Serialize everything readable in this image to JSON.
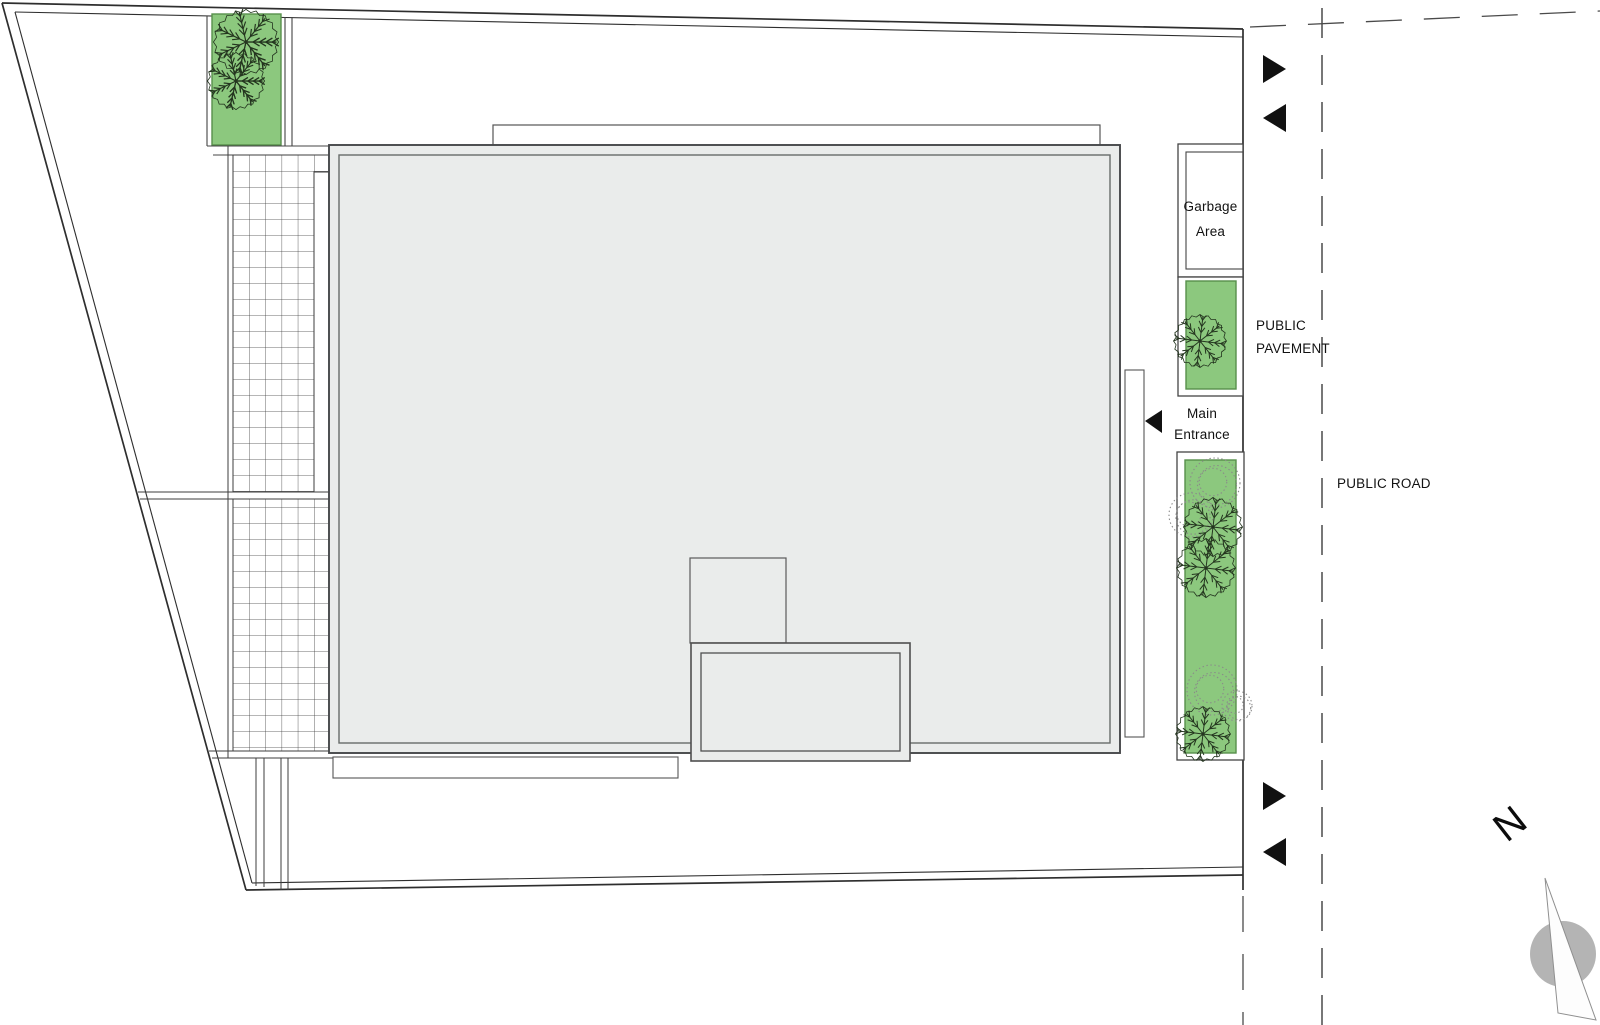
{
  "page_title": "Architectural site plan",
  "labels": {
    "garbage_line1": "Garbage",
    "garbage_line2": "Area",
    "pavement_line1": "PUBLIC",
    "pavement_line2": "PAVEMENT",
    "entrance_line1": "Main",
    "entrance_line2": "Entrance",
    "road": "PUBLIC ROAD",
    "north": "N"
  },
  "colors": {
    "planting_green": "#8cc87e",
    "planting_border": "#57904c",
    "building_fill": "#eaeceb",
    "line_dark": "#2e2e2e",
    "arrow_black": "#111111",
    "compass_gray": "#b4b4b4",
    "tree_stroke": "#24351f",
    "bush_stroke": "#8a8a8a"
  },
  "plan": {
    "trees": [
      {
        "x": 246,
        "y": 42,
        "r": 32,
        "style": "dense",
        "name": "tree-topleft-1"
      },
      {
        "x": 236,
        "y": 81,
        "r": 28,
        "style": "dense",
        "name": "tree-topleft-2"
      },
      {
        "x": 1200,
        "y": 341,
        "r": 26,
        "style": "snow",
        "name": "tree-pavement-strip"
      },
      {
        "x": 1213,
        "y": 527,
        "r": 29,
        "style": "snow",
        "name": "tree-road-strip-1"
      },
      {
        "x": 1206,
        "y": 568,
        "r": 29,
        "style": "snow",
        "name": "tree-road-strip-2"
      },
      {
        "x": 1203,
        "y": 734,
        "r": 27,
        "style": "snow",
        "name": "tree-road-strip-3"
      }
    ],
    "bushes": [
      {
        "x": 1215,
        "y": 483,
        "r": 25,
        "name": "bush-road-strip-1"
      },
      {
        "x": 1191,
        "y": 515,
        "r": 22,
        "name": "bush-road-strip-2"
      },
      {
        "x": 1212,
        "y": 690,
        "r": 25,
        "name": "bush-road-strip-3"
      },
      {
        "x": 1237,
        "y": 706,
        "r": 15,
        "name": "bush-road-strip-4"
      }
    ],
    "arrows": [
      {
        "points": "1263,55 1263,83 1286,69",
        "name": "traffic-arrow-top-right"
      },
      {
        "points": "1286,104 1286,132 1263,118",
        "name": "traffic-arrow-top-left"
      },
      {
        "points": "1162,410 1162,433 1145,421",
        "name": "main-entrance-arrow"
      },
      {
        "points": "1263,782 1263,810 1286,796",
        "name": "traffic-arrow-bottom-right"
      },
      {
        "points": "1286,838 1286,866 1263,852",
        "name": "traffic-arrow-bottom-left"
      }
    ],
    "compass": {
      "cx": 1563,
      "cy": 954,
      "r": 33,
      "needle_points": "1545,878 1558,1013 1596,1020"
    }
  }
}
